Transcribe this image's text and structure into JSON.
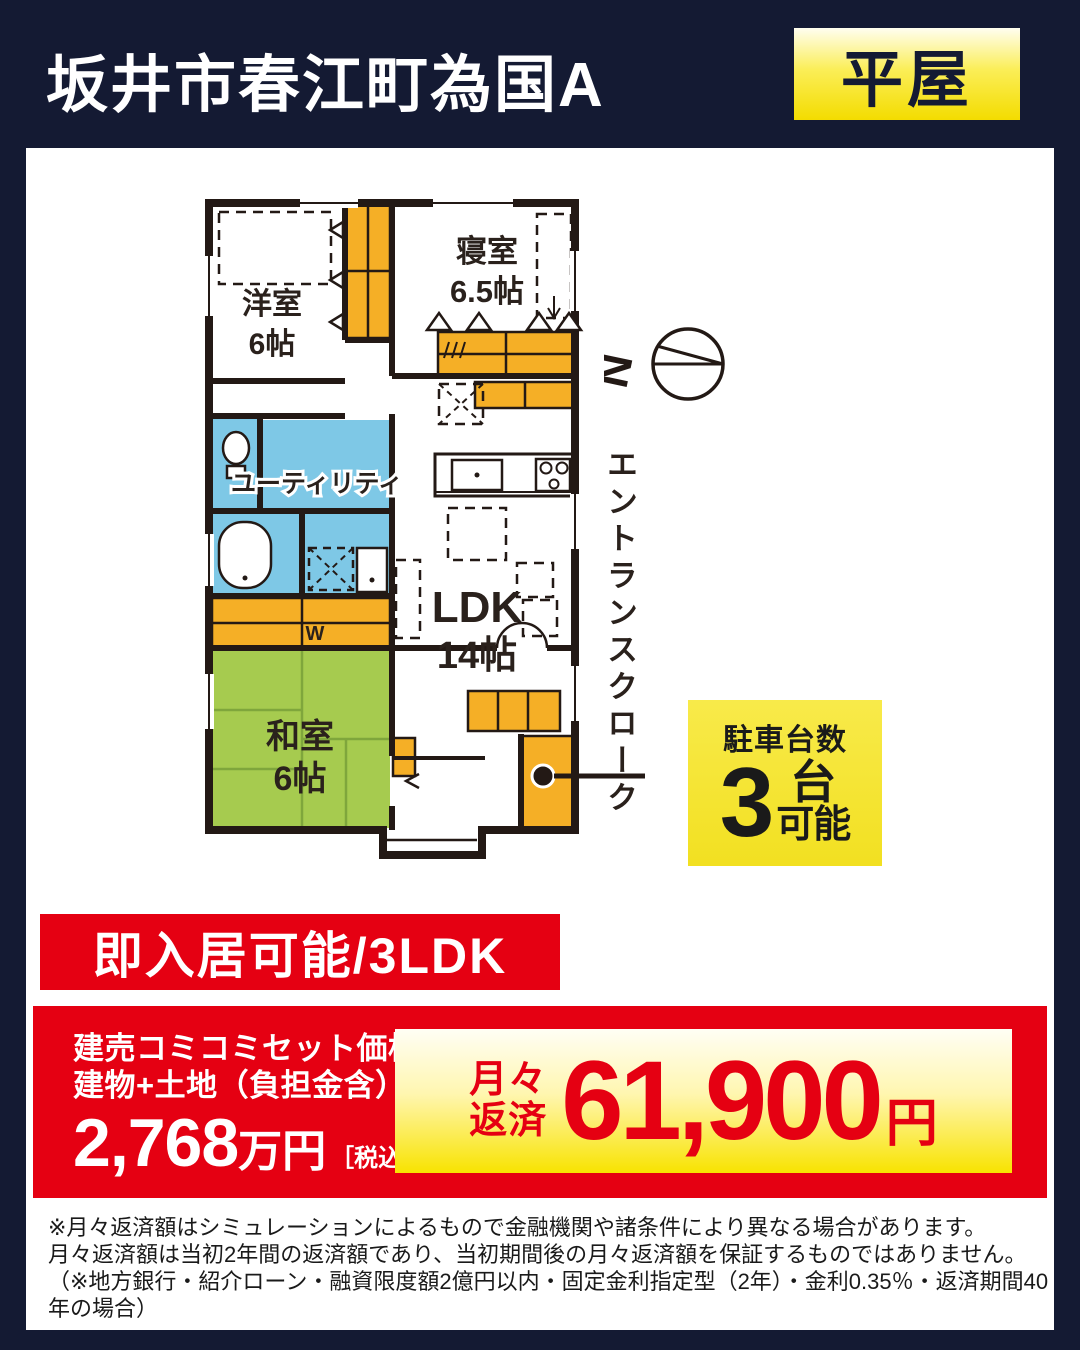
{
  "header": {
    "title": "坂井市春江町為国A",
    "badge": "平屋"
  },
  "floor_plan": {
    "rooms": {
      "western": {
        "name": "洋室",
        "size": "6帖"
      },
      "bedroom": {
        "name": "寝室",
        "size": "6.5帖"
      },
      "utility": {
        "label": "ユーティリティ"
      },
      "ldk": {
        "name": "LDK",
        "size": "14帖"
      },
      "japanese": {
        "name": "和室",
        "size": "6帖"
      }
    },
    "labels": {
      "entrance_cloak": "エントランスクローク",
      "closet_w": "W"
    },
    "compass": {
      "north": "N"
    },
    "colors": {
      "closet_orange": "#F5AF26",
      "water_blue": "#7EC8E6",
      "tatami_green": "#A6CB4F",
      "wall": "#231915"
    }
  },
  "parking": {
    "title": "駐車台数",
    "count": "3",
    "unit": "台",
    "suffix": "可能"
  },
  "ribbon": {
    "label": "即入居可能/3LDK"
  },
  "price_panel": {
    "set_line1": "建売コミコミセット価格",
    "set_line2": "建物+土地（負担金含）",
    "price_number": "2,768",
    "price_unit": "万円",
    "tax_note": "［税込］",
    "monthly_line1": "月々",
    "monthly_line2": "返済",
    "monthly_amount": "61,900",
    "monthly_unit": "円"
  },
  "disclaimer": {
    "line1": "※月々返済額はシミュレーションによるもので金融機関や諸条件により異なる場合があります。",
    "line2": "月々返済額は当初2年間の返済額であり、当初期間後の月々返済額を保証するものではありません。",
    "line3": "（※地方銀行・紹介ローン・融資限度額2億円以内・固定金利指定型（2年）・金利0.35％・返済期間40年の場合）"
  },
  "theme": {
    "navy": "#141A33",
    "red": "#E50012",
    "yellow": "#F5E32E",
    "white": "#FFFFFF"
  }
}
